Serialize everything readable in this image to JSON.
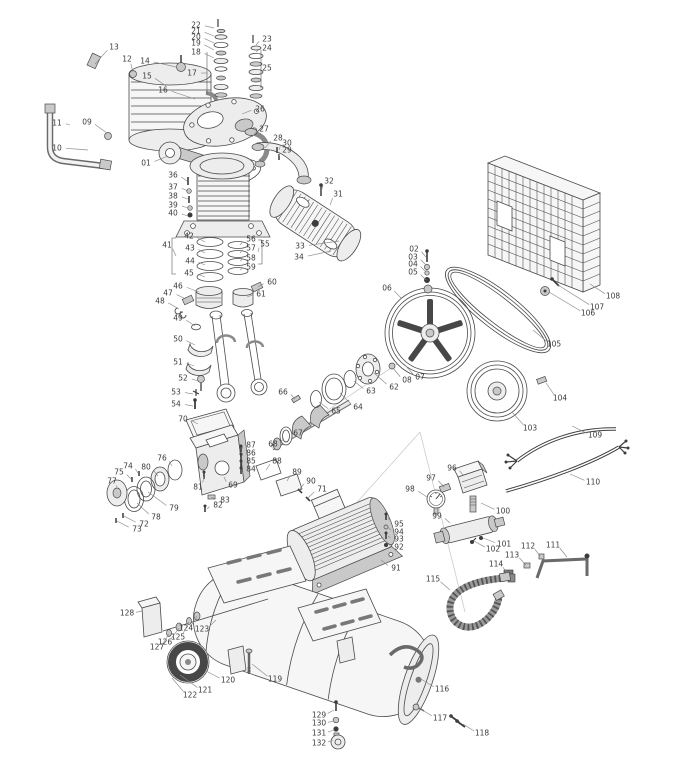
{
  "page": {
    "background": "#ffffff"
  },
  "diagram": {
    "type": "exploded-parts-diagram",
    "subject": "belt-driven air compressor exploded view with numbered parts",
    "colors": {
      "line": "#4a4a4a",
      "label": "#3a3a3a",
      "leader": "#8a8a8a",
      "dark": "#3c3c3c",
      "background": "#ffffff"
    },
    "label_font_px": 7.5,
    "labels": [
      [
        "01",
        146,
        163,
        168,
        156
      ],
      [
        "02",
        414,
        249,
        426,
        257
      ],
      [
        "03",
        413,
        257,
        426,
        265
      ],
      [
        "04",
        413,
        264,
        426,
        272
      ],
      [
        "05",
        413,
        272,
        426,
        280
      ],
      [
        "06",
        387,
        288,
        402,
        299
      ],
      [
        "07",
        420,
        377,
        404,
        364
      ],
      [
        "08",
        407,
        380,
        393,
        368
      ],
      [
        "09",
        87,
        122,
        107,
        133
      ],
      [
        "10",
        57,
        148,
        88,
        150
      ],
      [
        "11",
        57,
        123,
        70,
        125
      ],
      [
        "12",
        127,
        59,
        133,
        72
      ],
      [
        "13",
        114,
        47,
        95,
        64
      ],
      [
        "14",
        145,
        61,
        176,
        67
      ],
      [
        "15",
        147,
        76,
        166,
        86
      ],
      [
        "16",
        163,
        90,
        195,
        99
      ],
      [
        "17",
        192,
        73,
        207,
        73
      ],
      [
        "18",
        196,
        52,
        214,
        58
      ],
      [
        "19",
        196,
        43,
        214,
        50
      ],
      [
        "20",
        196,
        37,
        214,
        43
      ],
      [
        "21",
        196,
        31,
        214,
        36
      ],
      [
        "22",
        196,
        25,
        214,
        28
      ],
      [
        "23",
        267,
        39,
        256,
        45
      ],
      [
        "24",
        267,
        48,
        256,
        52
      ],
      [
        "25",
        267,
        68,
        258,
        68
      ],
      [
        "26",
        260,
        109,
        242,
        114
      ],
      [
        "27",
        264,
        129,
        252,
        137
      ],
      [
        "28",
        278,
        138,
        265,
        148
      ],
      [
        "29",
        287,
        150,
        279,
        156
      ],
      [
        "30",
        287,
        143,
        279,
        150
      ],
      [
        "31",
        338,
        194,
        330,
        205
      ],
      [
        "32",
        329,
        181,
        322,
        189
      ],
      [
        "33",
        300,
        246,
        339,
        241
      ],
      [
        "34",
        299,
        257,
        331,
        251
      ],
      [
        "36",
        173,
        175,
        187,
        181
      ],
      [
        "37",
        173,
        187,
        188,
        191
      ],
      [
        "38",
        173,
        196,
        188,
        199
      ],
      [
        "39",
        173,
        205,
        188,
        208
      ],
      [
        "40",
        173,
        213,
        188,
        216
      ],
      [
        "41",
        167,
        245,
        176,
        256
      ],
      [
        "42",
        189,
        236,
        205,
        242
      ],
      [
        "43",
        190,
        248,
        205,
        253
      ],
      [
        "44",
        190,
        261,
        205,
        265
      ],
      [
        "45",
        189,
        273,
        205,
        277
      ],
      [
        "46",
        178,
        286,
        199,
        292
      ],
      [
        "47",
        168,
        293,
        186,
        299
      ],
      [
        "48",
        160,
        301,
        179,
        309
      ],
      [
        "49",
        178,
        318,
        195,
        326
      ],
      [
        "50",
        178,
        339,
        195,
        345
      ],
      [
        "51",
        178,
        362,
        194,
        366
      ],
      [
        "52",
        183,
        378,
        198,
        381
      ],
      [
        "53",
        176,
        392,
        193,
        394
      ],
      [
        "54",
        176,
        404,
        193,
        406
      ],
      [
        "55",
        265,
        244,
        258,
        252
      ],
      [
        "56",
        251,
        239,
        240,
        245
      ],
      [
        "57",
        251,
        248,
        240,
        253
      ],
      [
        "58",
        251,
        258,
        240,
        261
      ],
      [
        "59",
        251,
        267,
        240,
        270
      ],
      [
        "60",
        272,
        282,
        258,
        287
      ],
      [
        "61",
        261,
        294,
        247,
        297
      ],
      [
        "62",
        394,
        387,
        374,
        373
      ],
      [
        "63",
        371,
        391,
        354,
        381
      ],
      [
        "64",
        358,
        407,
        340,
        393
      ],
      [
        "65",
        336,
        411,
        319,
        402
      ],
      [
        "66",
        283,
        392,
        295,
        399
      ],
      [
        "67",
        298,
        433,
        312,
        424
      ],
      [
        "68",
        273,
        444,
        284,
        438
      ],
      [
        "69",
        233,
        485,
        224,
        477
      ],
      [
        "70",
        183,
        419,
        198,
        424
      ],
      [
        "71",
        322,
        489,
        308,
        498
      ],
      [
        "72",
        144,
        524,
        124,
        516
      ],
      [
        "73",
        137,
        529,
        117,
        521
      ],
      [
        "74",
        128,
        466,
        138,
        473
      ],
      [
        "75",
        119,
        472,
        131,
        479
      ],
      [
        "76",
        162,
        458,
        172,
        466
      ],
      [
        "77",
        112,
        481,
        117,
        489
      ],
      [
        "78",
        156,
        517,
        137,
        503
      ],
      [
        "79",
        174,
        508,
        148,
        492
      ],
      [
        "80",
        146,
        467,
        158,
        476
      ],
      [
        "81",
        198,
        487,
        204,
        477
      ],
      [
        "82",
        218,
        505,
        207,
        509
      ],
      [
        "83",
        225,
        500,
        211,
        497
      ],
      [
        "84",
        251,
        469,
        242,
        471
      ],
      [
        "85",
        251,
        461,
        242,
        464
      ],
      [
        "86",
        251,
        453,
        242,
        456
      ],
      [
        "87",
        251,
        445,
        242,
        449
      ],
      [
        "88",
        277,
        461,
        266,
        470
      ],
      [
        "89",
        297,
        472,
        287,
        481
      ],
      [
        "90",
        311,
        481,
        299,
        490
      ],
      [
        "91",
        396,
        568,
        381,
        560
      ],
      [
        "92",
        399,
        547,
        388,
        544
      ],
      [
        "93",
        399,
        539,
        388,
        536
      ],
      [
        "94",
        399,
        532,
        388,
        527
      ],
      [
        "95",
        399,
        524,
        388,
        518
      ],
      [
        "96",
        452,
        468,
        463,
        475
      ],
      [
        "97",
        431,
        478,
        444,
        487
      ],
      [
        "98",
        410,
        489,
        427,
        497
      ],
      [
        "99",
        437,
        516,
        450,
        523
      ],
      [
        "100",
        503,
        511,
        481,
        503
      ],
      [
        "101",
        504,
        544,
        483,
        538
      ],
      [
        "102",
        493,
        549,
        474,
        541
      ],
      [
        "103",
        530,
        428,
        512,
        412
      ],
      [
        "104",
        560,
        398,
        546,
        383
      ],
      [
        "105",
        554,
        344,
        533,
        330
      ],
      [
        "106",
        588,
        313,
        549,
        292
      ],
      [
        "107",
        597,
        307,
        558,
        285
      ],
      [
        "108",
        613,
        296,
        590,
        284
      ],
      [
        "109",
        595,
        435,
        572,
        426
      ],
      [
        "110",
        593,
        482,
        570,
        474
      ],
      [
        "111",
        553,
        545,
        567,
        557
      ],
      [
        "112",
        528,
        546,
        540,
        556
      ],
      [
        "113",
        512,
        555,
        526,
        565
      ],
      [
        "114",
        496,
        564,
        507,
        573
      ],
      [
        "115",
        433,
        579,
        450,
        590
      ],
      [
        "116",
        442,
        689,
        421,
        679
      ],
      [
        "117",
        440,
        718,
        419,
        708
      ],
      [
        "118",
        482,
        733,
        463,
        724
      ],
      [
        "119",
        275,
        679,
        252,
        664
      ],
      [
        "120",
        228,
        680,
        206,
        671
      ],
      [
        "121",
        205,
        690,
        180,
        675
      ],
      [
        "122",
        190,
        695,
        172,
        678
      ],
      [
        "123",
        202,
        629,
        216,
        620
      ],
      [
        "124",
        186,
        628,
        197,
        616
      ],
      [
        "125",
        178,
        637,
        189,
        622
      ],
      [
        "126",
        165,
        642,
        179,
        628
      ],
      [
        "127",
        157,
        647,
        169,
        634
      ],
      [
        "128",
        127,
        613,
        142,
        611
      ],
      [
        "129",
        319,
        715,
        334,
        710
      ],
      [
        "130",
        319,
        723,
        334,
        721
      ],
      [
        "131",
        319,
        733,
        334,
        730
      ],
      [
        "132",
        319,
        743,
        333,
        740
      ]
    ]
  }
}
